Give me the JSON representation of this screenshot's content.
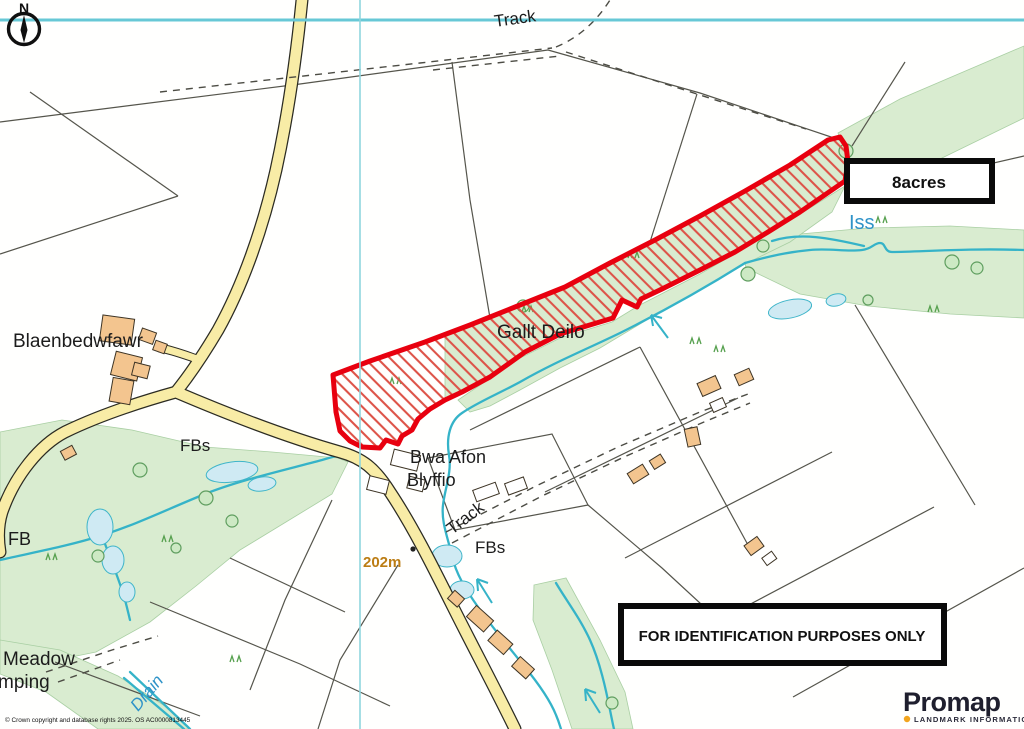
{
  "map": {
    "compass": {
      "label": "N"
    },
    "labels": {
      "track_top": "Track",
      "blaenbedwfawr": "Blaenbedwfawr",
      "gallt_deilo": "Gallt Deilo",
      "bwa_afon_1": "Bwa Afon",
      "bwa_afon_2": "Blyffio",
      "fbs_west": "FBs",
      "fb_west": "FB",
      "track_mid": "Track",
      "fbs_mid": "FBs",
      "spot_height": "202m",
      "meadow_1": "Meadow",
      "meadow_2": "mping",
      "drain": "Drain",
      "iss": "Iss"
    },
    "area_badge": "8acres",
    "notice": "FOR IDENTIFICATION PURPOSES ONLY",
    "copyright": "© Crown copyright and database rights 2025. OS AC0000813445",
    "logo": {
      "name": "Promap",
      "tagline": "LANDMARK INFORMATION"
    },
    "colors": {
      "parcel_outline": "#e8000f",
      "parcel_hatch": "#dd5348",
      "road_fill": "#f8eca6",
      "woodland": "#d9ecd0",
      "water": "#35b3c8",
      "pond": "#cfeaf3",
      "grid_line": "#67c8d6",
      "building": "#f3c58f",
      "spot_height_text": "#bc7d14",
      "water_label": "#2f93c8",
      "logo_accent": "#f2a51f"
    }
  }
}
